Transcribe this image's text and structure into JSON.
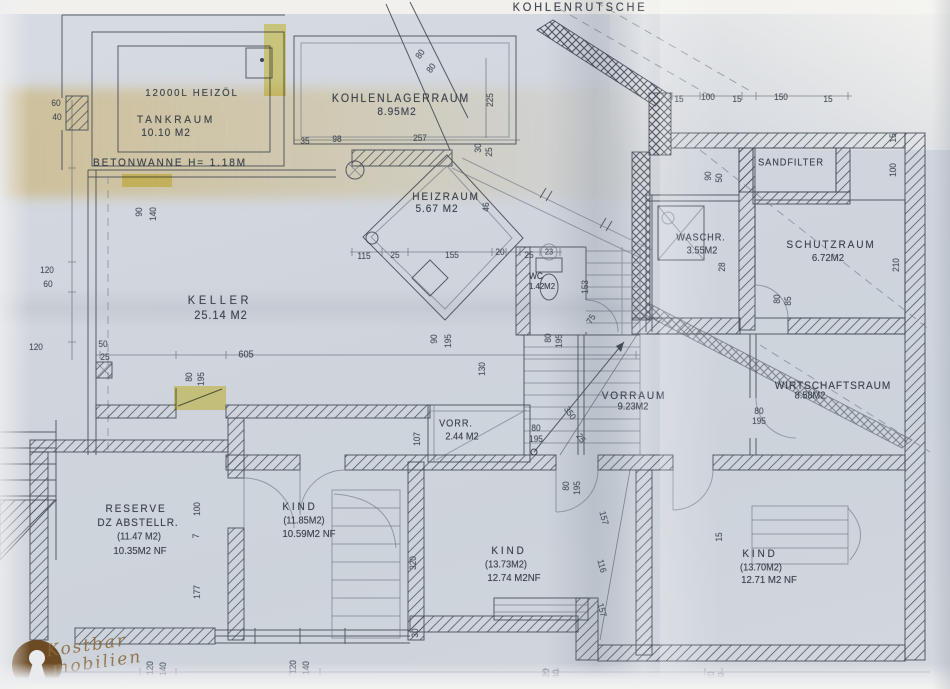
{
  "document": {
    "kind": "scanned basement floor plan",
    "language": "German"
  },
  "logo": {
    "line1": "Kostbar",
    "line2": "mobilien"
  },
  "colors": {
    "paper": "#d2d7de",
    "ink": "#3f4650",
    "highlight": "#e6cf2e",
    "logo_brown": "#6b4a24",
    "fold_tan": "#cbb782"
  },
  "rooms": [
    {
      "label": "TANKRAUM",
      "area": "10.10 M2",
      "note": "12000L HEIZÖL"
    },
    {
      "label": "BETONWANNE",
      "note": "H= 1.18M"
    },
    {
      "label": "KOHLENLAGERRAUM",
      "area": "8.95M2"
    },
    {
      "label": "KOHLENRUTSCHE"
    },
    {
      "label": "HEIZRAUM",
      "area": "5.67 M2"
    },
    {
      "label": "WC",
      "area": "1.42M2"
    },
    {
      "label": "WASCHR.",
      "area": "3.55M2"
    },
    {
      "label": "SANDFILTER"
    },
    {
      "label": "SCHUTZRAUM",
      "area": "6.72M2"
    },
    {
      "label": "KELLER",
      "area": "25.14 M2"
    },
    {
      "label": "VORRAUM",
      "area": "9.23M2"
    },
    {
      "label": "WIRTSCHAFTSRAUM",
      "area": "8.58M2"
    },
    {
      "label": "VORR.",
      "area": "2.44 M2"
    },
    {
      "label": "RESERVE DZ ABSTELLR.",
      "area": "(11.47 M2)",
      "net": "10.35M2 NF"
    },
    {
      "label": "KIND",
      "area": "(11.85M2)",
      "net": "10.59M2 NF"
    },
    {
      "label": "KIND",
      "area": "(13.73M2)",
      "net": "12.74 M2NF"
    },
    {
      "label": "KIND",
      "area": "(13.70M2)",
      "net": "12.71 M2 NF"
    }
  ],
  "labels": [
    {
      "t": "12000L HEIZÖL",
      "x": 192,
      "y": 93,
      "s": 10.5,
      "ls": 2,
      "c": "room"
    },
    {
      "t": "TANKRAUM",
      "x": 176,
      "y": 120,
      "s": 11,
      "ls": 3,
      "c": "room"
    },
    {
      "t": "10.10 M2",
      "x": 166,
      "y": 133,
      "s": 11,
      "ls": 1,
      "c": "room"
    },
    {
      "t": "BETONWANNE H= 1.18M",
      "x": 170,
      "y": 163,
      "s": 11,
      "ls": 2,
      "c": "room"
    },
    {
      "t": "KOHLENLAGERRAUM",
      "x": 401,
      "y": 99,
      "s": 11.5,
      "ls": 2,
      "c": "room"
    },
    {
      "t": "8.95M2",
      "x": 397,
      "y": 112,
      "s": 11,
      "ls": 1,
      "c": "room"
    },
    {
      "t": "KOHLENRUTSCHE",
      "x": 580,
      "y": 7,
      "s": 12,
      "ls": 3,
      "c": "room"
    },
    {
      "t": "HEIZRAUM",
      "x": 446,
      "y": 197,
      "s": 11,
      "ls": 2,
      "c": "room"
    },
    {
      "t": "5.67 M2",
      "x": 437,
      "y": 209,
      "s": 11,
      "ls": 1,
      "c": "room"
    },
    {
      "t": "WC",
      "x": 536,
      "y": 276,
      "s": 9,
      "c": "room"
    },
    {
      "t": "1.42M2",
      "x": 542,
      "y": 286,
      "s": 8.5,
      "c": "room"
    },
    {
      "t": "WASCHR.",
      "x": 701,
      "y": 238,
      "s": 10,
      "ls": 1,
      "c": "room"
    },
    {
      "t": "3.55M2",
      "x": 702,
      "y": 251,
      "s": 10,
      "c": "room"
    },
    {
      "t": "SANDFILTER",
      "x": 791,
      "y": 163,
      "s": 10,
      "ls": 1,
      "c": "room"
    },
    {
      "t": "SCHUTZRAUM",
      "x": 831,
      "y": 245,
      "s": 11,
      "ls": 2,
      "c": "room"
    },
    {
      "t": "6.72M2",
      "x": 828,
      "y": 258,
      "s": 10.5,
      "c": "room"
    },
    {
      "t": "KELLER",
      "x": 220,
      "y": 300,
      "s": 12,
      "ls": 4,
      "c": "room"
    },
    {
      "t": "25.14 M2",
      "x": 221,
      "y": 315,
      "s": 12,
      "ls": 1,
      "c": "room"
    },
    {
      "t": "VORRAUM",
      "x": 634,
      "y": 396,
      "s": 11,
      "ls": 2,
      "c": "room"
    },
    {
      "t": "9.23M2",
      "x": 633,
      "y": 407,
      "s": 10,
      "c": "room"
    },
    {
      "t": "WIRTSCHAFTSRAUM",
      "x": 833,
      "y": 386,
      "s": 11,
      "ls": 1,
      "c": "room"
    },
    {
      "t": "8.58M2",
      "x": 810,
      "y": 396,
      "s": 10,
      "c": "room"
    },
    {
      "t": "VORR.",
      "x": 456,
      "y": 424,
      "s": 10,
      "ls": 1,
      "c": "room"
    },
    {
      "t": "2.44 M2",
      "x": 462,
      "y": 437,
      "s": 10,
      "c": "room"
    },
    {
      "t": "RESERVE",
      "x": 136,
      "y": 509,
      "s": 11,
      "ls": 2,
      "c": "room"
    },
    {
      "t": "DZ ABSTELLR.",
      "x": 138,
      "y": 523,
      "s": 11,
      "ls": 1,
      "c": "room"
    },
    {
      "t": "(11.47 M2)",
      "x": 139,
      "y": 537,
      "s": 10,
      "c": "room"
    },
    {
      "t": "10.35M2 NF",
      "x": 140,
      "y": 551,
      "s": 10.5,
      "c": "room"
    },
    {
      "t": "KIND",
      "x": 300,
      "y": 507,
      "s": 11,
      "ls": 3,
      "c": "room"
    },
    {
      "t": "(11.85M2)",
      "x": 304,
      "y": 521,
      "s": 10,
      "c": "room"
    },
    {
      "t": "10.59M2 NF",
      "x": 309,
      "y": 534,
      "s": 10.5,
      "c": "room"
    },
    {
      "t": "KIND",
      "x": 509,
      "y": 551,
      "s": 11,
      "ls": 3,
      "c": "room"
    },
    {
      "t": "(13.73M2)",
      "x": 506,
      "y": 565,
      "s": 10,
      "c": "room"
    },
    {
      "t": "12.74 M2NF",
      "x": 514,
      "y": 578,
      "s": 10.5,
      "c": "room"
    },
    {
      "t": "KIND",
      "x": 760,
      "y": 554,
      "s": 11,
      "ls": 3,
      "c": "room"
    },
    {
      "t": "(13.70M2)",
      "x": 761,
      "y": 568,
      "s": 10,
      "c": "room"
    },
    {
      "t": "12.71 M2 NF",
      "x": 769,
      "y": 580,
      "s": 10.5,
      "c": "room"
    },
    {
      "t": "60",
      "x": 56,
      "y": 103,
      "c": "dim"
    },
    {
      "t": "40",
      "x": 57,
      "y": 117,
      "c": "dim"
    },
    {
      "t": "90",
      "x": 139,
      "y": 212,
      "r": -90,
      "c": "dim"
    },
    {
      "t": "140",
      "x": 153,
      "y": 214,
      "r": -90,
      "c": "dim"
    },
    {
      "t": "120",
      "x": 47,
      "y": 270,
      "c": "dim"
    },
    {
      "t": "60",
      "x": 48,
      "y": 284,
      "c": "dim"
    },
    {
      "t": "120",
      "x": 36,
      "y": 347,
      "c": "dim"
    },
    {
      "t": "50",
      "x": 103,
      "y": 344,
      "c": "dim"
    },
    {
      "t": "25",
      "x": 105,
      "y": 357,
      "c": "dim"
    },
    {
      "t": "35",
      "x": 305,
      "y": 141,
      "c": "dim"
    },
    {
      "t": "98",
      "x": 337,
      "y": 139,
      "c": "dim"
    },
    {
      "t": "257",
      "x": 420,
      "y": 138,
      "c": "dim"
    },
    {
      "t": "80",
      "x": 420,
      "y": 54,
      "r": -55,
      "c": "dim"
    },
    {
      "t": "80",
      "x": 431,
      "y": 68,
      "r": -55,
      "c": "dim"
    },
    {
      "t": "225",
      "x": 490,
      "y": 100,
      "r": -90,
      "c": "dim"
    },
    {
      "t": "30",
      "x": 478,
      "y": 148,
      "r": -90,
      "c": "dim"
    },
    {
      "t": "25",
      "x": 489,
      "y": 152,
      "r": -90,
      "c": "dim"
    },
    {
      "t": "15",
      "x": 679,
      "y": 99,
      "c": "dim"
    },
    {
      "t": "100",
      "x": 708,
      "y": 97,
      "c": "dim"
    },
    {
      "t": "15",
      "x": 737,
      "y": 99,
      "c": "dim"
    },
    {
      "t": "150",
      "x": 781,
      "y": 97,
      "c": "dim"
    },
    {
      "t": "15",
      "x": 828,
      "y": 99,
      "c": "dim"
    },
    {
      "t": "15",
      "x": 893,
      "y": 138,
      "r": -90,
      "c": "dim"
    },
    {
      "t": "100",
      "x": 893,
      "y": 170,
      "r": -90,
      "c": "dim"
    },
    {
      "t": "90",
      "x": 708,
      "y": 176,
      "r": -90,
      "c": "dim"
    },
    {
      "t": "50",
      "x": 719,
      "y": 178,
      "r": -90,
      "c": "dim"
    },
    {
      "t": "115",
      "x": 364,
      "y": 256,
      "c": "dim"
    },
    {
      "t": "25",
      "x": 395,
      "y": 255,
      "c": "dim"
    },
    {
      "t": "155",
      "x": 452,
      "y": 255,
      "c": "dim"
    },
    {
      "t": "20",
      "x": 500,
      "y": 252,
      "c": "dim"
    },
    {
      "t": "25",
      "x": 529,
      "y": 255,
      "c": "dim"
    },
    {
      "t": "23",
      "x": 549,
      "y": 252,
      "s": 8,
      "c": "dim"
    },
    {
      "t": "46",
      "x": 486,
      "y": 207,
      "r": -90,
      "c": "dim"
    },
    {
      "t": "153",
      "x": 585,
      "y": 287,
      "r": -90,
      "c": "dim"
    },
    {
      "t": "75",
      "x": 591,
      "y": 319,
      "r": -60,
      "c": "dim"
    },
    {
      "t": "80",
      "x": 548,
      "y": 338,
      "r": -90,
      "c": "dim"
    },
    {
      "t": "195",
      "x": 559,
      "y": 341,
      "r": -90,
      "c": "dim"
    },
    {
      "t": "90",
      "x": 434,
      "y": 339,
      "r": -90,
      "c": "dim"
    },
    {
      "t": "195",
      "x": 448,
      "y": 341,
      "r": -90,
      "c": "dim"
    },
    {
      "t": "130",
      "x": 482,
      "y": 369,
      "r": -90,
      "c": "dim"
    },
    {
      "t": "605",
      "x": 246,
      "y": 355,
      "s": 10,
      "c": "dim"
    },
    {
      "t": "80",
      "x": 189,
      "y": 377,
      "r": -90,
      "c": "dim"
    },
    {
      "t": "195",
      "x": 201,
      "y": 379,
      "r": -90,
      "c": "dim"
    },
    {
      "t": "28",
      "x": 722,
      "y": 267,
      "r": -90,
      "c": "dim"
    },
    {
      "t": "210",
      "x": 896,
      "y": 265,
      "r": -90,
      "c": "dim"
    },
    {
      "t": "80",
      "x": 777,
      "y": 299,
      "r": -90,
      "c": "dim"
    },
    {
      "t": "85",
      "x": 788,
      "y": 301,
      "r": -90,
      "c": "dim"
    },
    {
      "t": "80",
      "x": 759,
      "y": 411,
      "c": "dim"
    },
    {
      "t": "195",
      "x": 759,
      "y": 421,
      "c": "dim"
    },
    {
      "t": "107",
      "x": 417,
      "y": 439,
      "r": -90,
      "c": "dim"
    },
    {
      "t": "80",
      "x": 536,
      "y": 428,
      "c": "dim"
    },
    {
      "t": "195",
      "x": 536,
      "y": 439,
      "c": "dim"
    },
    {
      "t": "80",
      "x": 566,
      "y": 486,
      "r": -90,
      "c": "dim"
    },
    {
      "t": "195",
      "x": 577,
      "y": 488,
      "r": -90,
      "c": "dim"
    },
    {
      "t": "350",
      "x": 570,
      "y": 413,
      "r": 55,
      "c": "dim"
    },
    {
      "t": "25",
      "x": 581,
      "y": 438,
      "r": 55,
      "c": "dim"
    },
    {
      "t": "100",
      "x": 197,
      "y": 509,
      "r": -90,
      "c": "dim"
    },
    {
      "t": "7",
      "x": 196,
      "y": 536,
      "r": -90,
      "c": "dim"
    },
    {
      "t": "177",
      "x": 197,
      "y": 592,
      "r": -90,
      "c": "dim"
    },
    {
      "t": "320",
      "x": 413,
      "y": 563,
      "r": -90,
      "c": "dim"
    },
    {
      "t": "157",
      "x": 604,
      "y": 518,
      "r": 75,
      "c": "dim"
    },
    {
      "t": "116",
      "x": 602,
      "y": 566,
      "r": 75,
      "c": "dim"
    },
    {
      "t": "157",
      "x": 602,
      "y": 610,
      "r": 75,
      "c": "dim"
    },
    {
      "t": "15",
      "x": 719,
      "y": 537,
      "r": -90,
      "c": "dim"
    },
    {
      "t": "30",
      "x": 415,
      "y": 633,
      "r": -90,
      "c": "dim"
    },
    {
      "t": "20",
      "x": 546,
      "y": 673,
      "r": -90,
      "c": "dim"
    },
    {
      "t": "40",
      "x": 556,
      "y": 674,
      "r": -90,
      "c": "dim"
    },
    {
      "t": "20",
      "x": 711,
      "y": 676,
      "r": -90,
      "c": "dim"
    },
    {
      "t": "40",
      "x": 721,
      "y": 677,
      "r": -90,
      "c": "dim"
    },
    {
      "t": "120",
      "x": 150,
      "y": 668,
      "r": -90,
      "c": "dim"
    },
    {
      "t": "140",
      "x": 163,
      "y": 669,
      "r": -90,
      "c": "dim"
    },
    {
      "t": "120",
      "x": 293,
      "y": 667,
      "r": -90,
      "c": "dim"
    },
    {
      "t": "140",
      "x": 306,
      "y": 668,
      "r": -90,
      "c": "dim"
    }
  ]
}
